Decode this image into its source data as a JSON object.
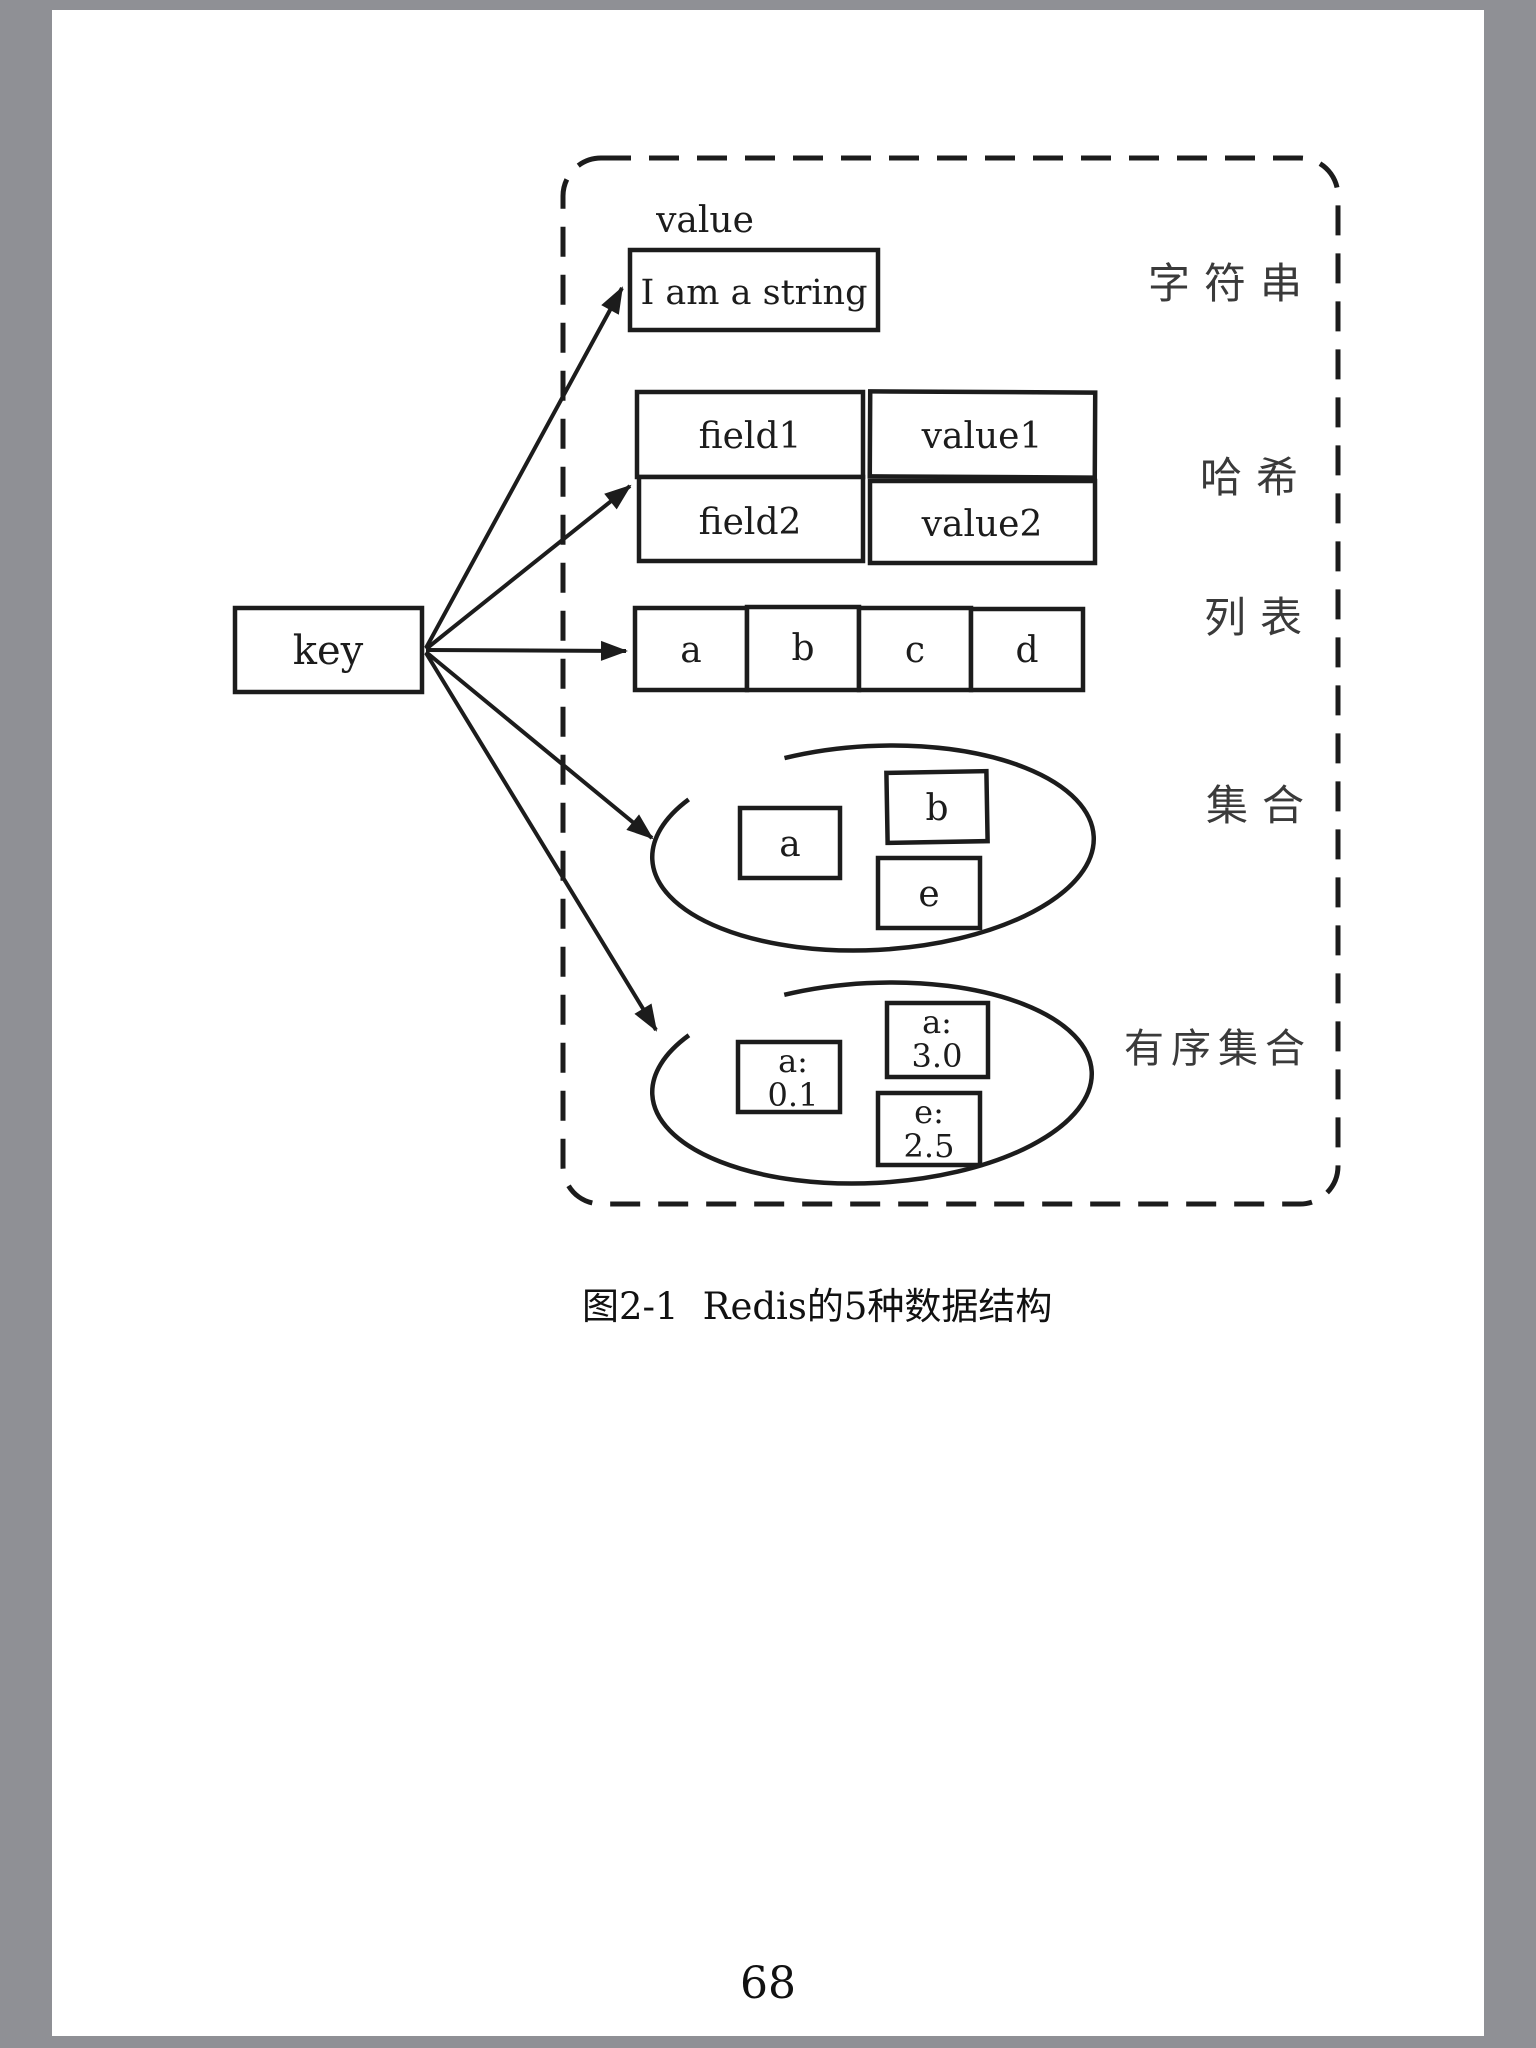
{
  "page": {
    "number": "68"
  },
  "caption": {
    "figure_label": "图2-1",
    "title": "Redis的5种数据结构"
  },
  "diagram": {
    "key_label": "key",
    "value_header": "value",
    "string_value": "I am a string",
    "hash_rows": [
      {
        "field": "field1",
        "value": "value1"
      },
      {
        "field": "field2",
        "value": "value2"
      }
    ],
    "list_items": [
      "a",
      "b",
      "c",
      "d"
    ],
    "set_items": [
      "a",
      "b",
      "e"
    ],
    "zset_items": [
      {
        "member": "a:",
        "score": "0.1"
      },
      {
        "member": "a:",
        "score": "3.0"
      },
      {
        "member": "e:",
        "score": "2.5"
      }
    ],
    "type_labels": {
      "string": "字符串",
      "hash": "哈希",
      "list": "列表",
      "set": "集合",
      "zset": "有序集合"
    }
  },
  "colors": {
    "ink": "#1c1c1c",
    "paper": "#ffffff",
    "background": "#8f9095"
  }
}
